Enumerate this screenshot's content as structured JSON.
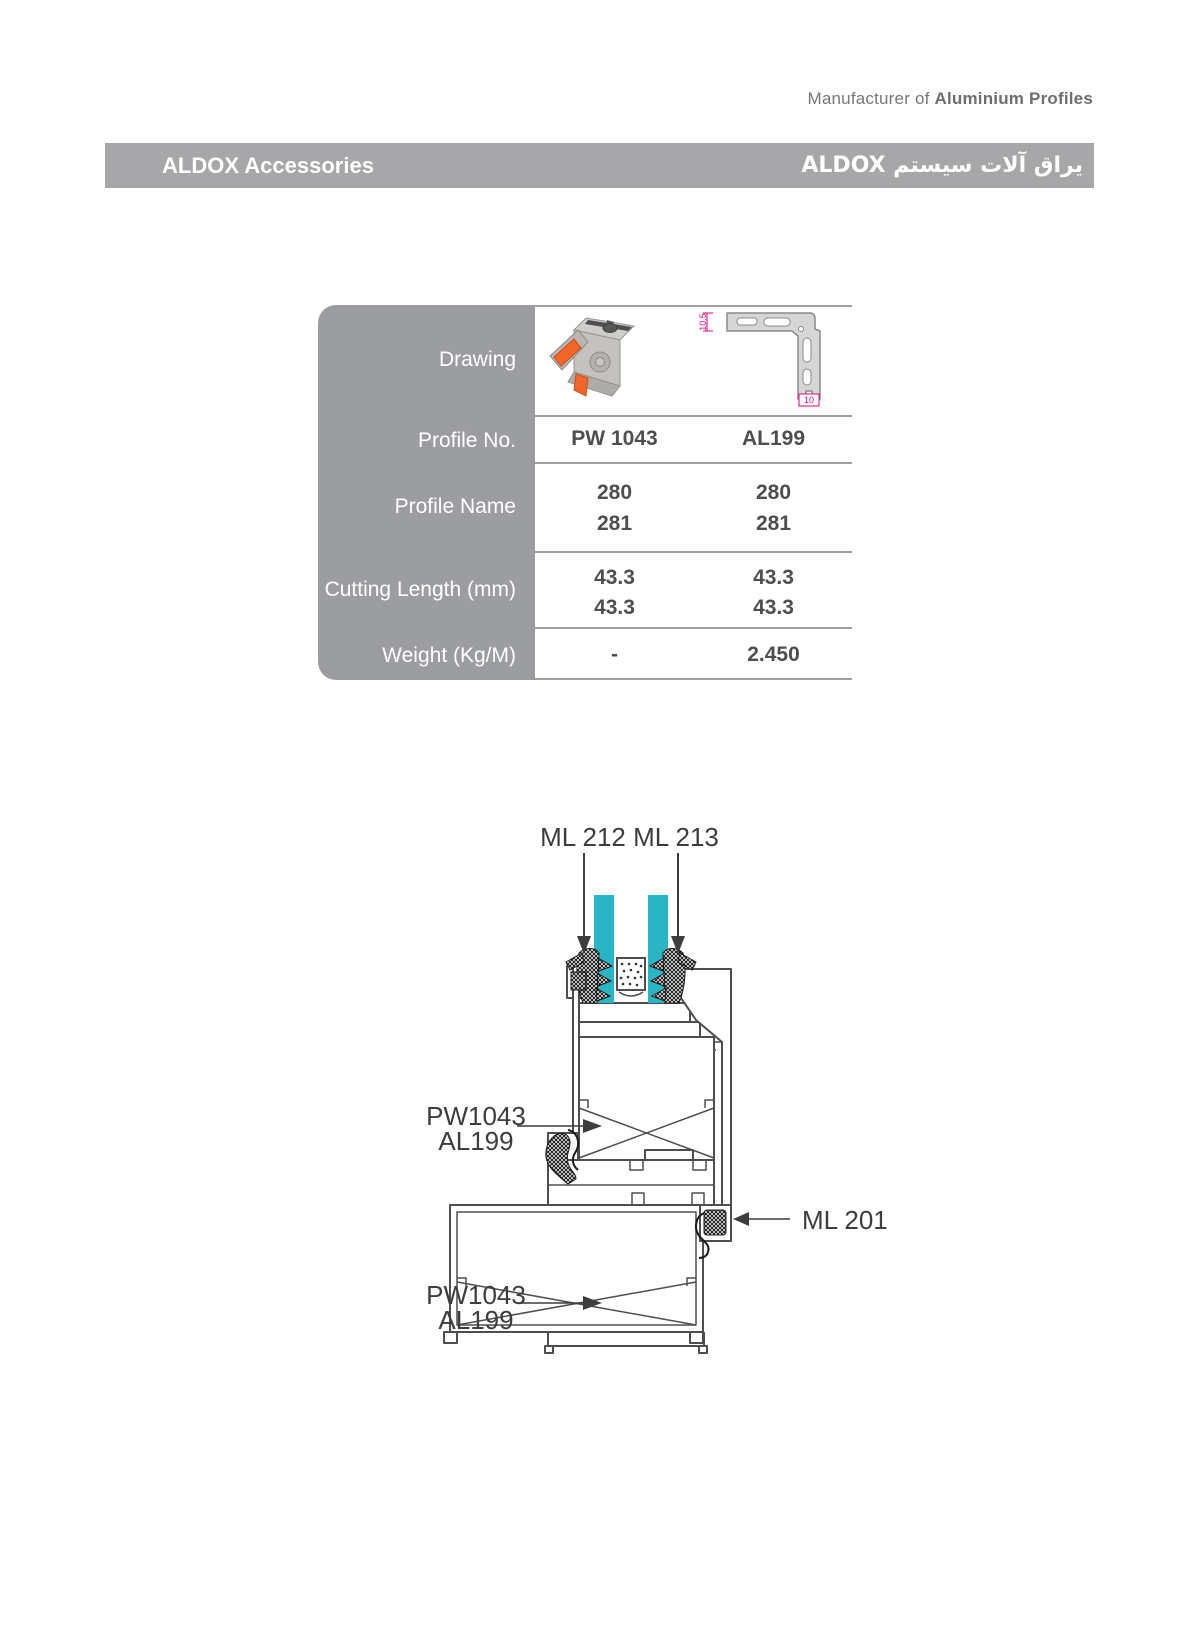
{
  "tagline": {
    "prefix": "Manufacturer of ",
    "bold": "Aluminium Profiles"
  },
  "titlebar": {
    "left": "ALDOX Accessories",
    "right_ar": "یراق آلات سیستم",
    "right_latin": "ALDOX"
  },
  "table": {
    "labels": [
      "Drawing",
      "Profile No.",
      "Profile Name",
      "Cutting Length (mm)",
      "Weight (Kg/M)"
    ],
    "cols": [
      {
        "no": "PW 1043",
        "name1": "280",
        "name2": "281",
        "len1": "43.3",
        "len2": "43.3",
        "weight": "-"
      },
      {
        "no": "AL199",
        "name1": "280",
        "name2": "281",
        "len1": "43.3",
        "len2": "43.3",
        "weight": "2.450"
      }
    ],
    "drawing_dims": {
      "height": "10.5",
      "width": "10"
    }
  },
  "diagram": {
    "ml212": "ML 212",
    "ml213": "ML 213",
    "ml201": "ML 201",
    "callout_top": {
      "line1": "PW1043",
      "line2": "AL199"
    },
    "callout_bottom": {
      "line1": "PW1043",
      "line2": "AL199"
    }
  },
  "colors": {
    "bar_gray": "#a7a7a9",
    "panel_gray": "#9c9da0",
    "glass_cyan": "#2ab5c5",
    "pad_orange": "#f1662a",
    "dim_pink": "#e6007e",
    "line_dark": "#4d4e50"
  }
}
